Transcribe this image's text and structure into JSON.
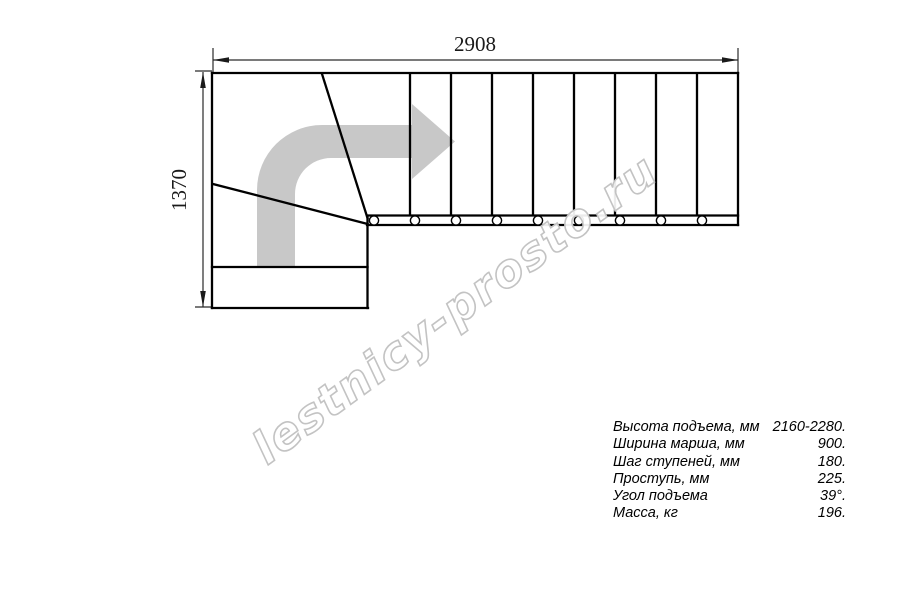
{
  "drawing": {
    "width_label": "2908",
    "height_label": "1370",
    "tread_count": 9
  },
  "watermark": {
    "text": "lestnicy-prosto.ru"
  },
  "specs": {
    "rows": [
      {
        "label": "Высота подъема, мм",
        "value": "2160-2280."
      },
      {
        "label": "Ширина марша, мм",
        "value": "900."
      },
      {
        "label": "Шаг ступеней, мм",
        "value": "180."
      },
      {
        "label": "Проступь, мм",
        "value": "225."
      },
      {
        "label": "Угол подъема",
        "value": "39°."
      },
      {
        "label": "Масса, кг",
        "value": "196."
      }
    ]
  },
  "colors": {
    "line": "#000000",
    "direction_arrow_gray": "#c8c8c8",
    "watermark_outline_gray": "#c3c3c3"
  }
}
